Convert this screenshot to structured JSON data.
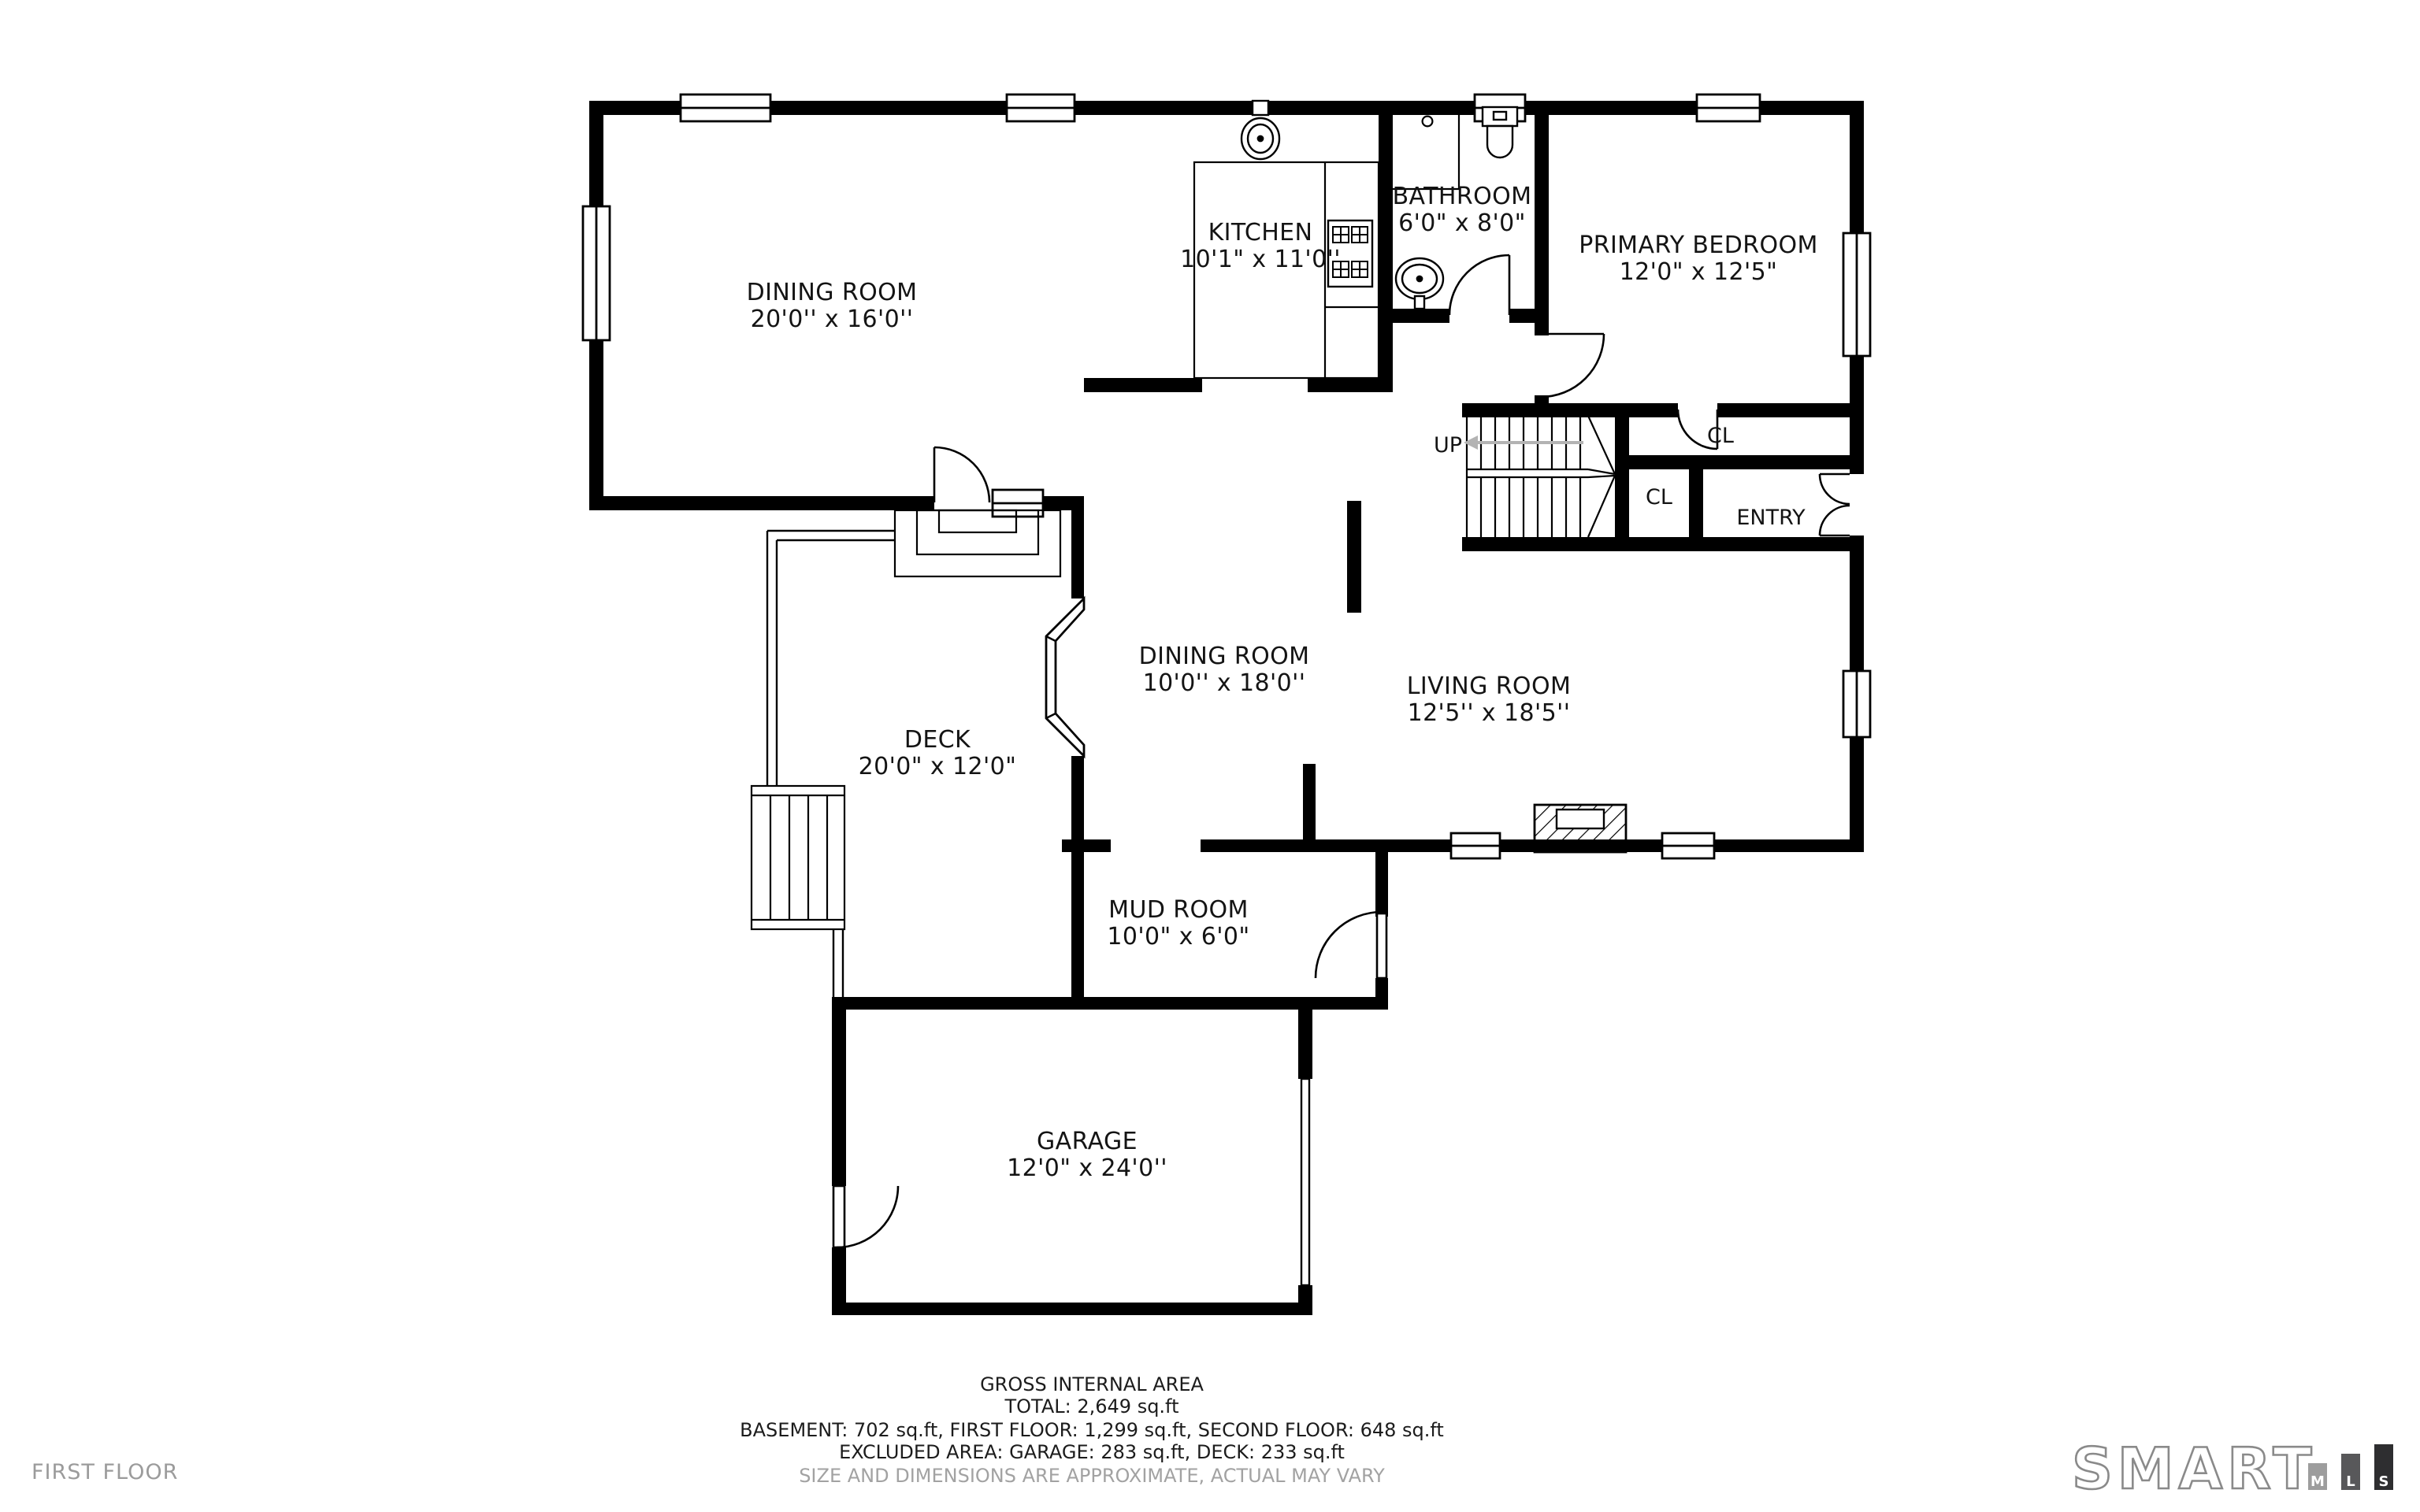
{
  "page": {
    "floor_label": "FIRST FLOOR"
  },
  "rooms": {
    "dining_main": {
      "name": "DINING ROOM",
      "dims": "20'0'' x 16'0''"
    },
    "kitchen": {
      "name": "KITCHEN",
      "dims": "10'1\" x 11'0''"
    },
    "bathroom": {
      "name": "BATHROOM",
      "dims": "6'0\" x 8'0\""
    },
    "primary_bedroom": {
      "name": "PRIMARY BEDROOM",
      "dims": "12'0\" x 12'5\""
    },
    "dining_mid": {
      "name": "DINING ROOM",
      "dims": "10'0'' x 18'0''"
    },
    "living": {
      "name": "LIVING ROOM",
      "dims": "12'5'' x 18'5''"
    },
    "deck": {
      "name": "DECK",
      "dims": "20'0\" x 12'0\""
    },
    "mud_room": {
      "name": "MUD ROOM",
      "dims": "10'0\" x 6'0\""
    },
    "garage": {
      "name": "GARAGE",
      "dims": "12'0\" x 24'0''"
    }
  },
  "plan_labels": {
    "up": "UP",
    "closet_top": "CL",
    "closet_bottom": "CL",
    "entry": "ENTRY"
  },
  "footer": {
    "line1": "GROSS INTERNAL AREA",
    "line2": "TOTAL: 2,649 sq.ft",
    "line3": "BASEMENT: 702 sq.ft, FIRST FLOOR: 1,299 sq.ft, SECOND FLOOR: 648 sq.ft",
    "line4": "EXCLUDED AREA: GARAGE: 283 sq.ft, DECK: 233 sq.ft",
    "line5": "SIZE AND DIMENSIONS ARE APPROXIMATE, ACTUAL MAY VARY"
  },
  "logo": {
    "word": "SMART",
    "bars": [
      "M",
      "L",
      "S"
    ]
  },
  "colors": {
    "wall": "#000000",
    "muted_text": "#a2a2a2",
    "floor_text": "#9b9b9b",
    "logo_bar_m": "#9d9d9d",
    "logo_bar_l": "#58585a",
    "logo_bar_s": "#2e2e30",
    "up_arrow": "#b3b3b3"
  }
}
